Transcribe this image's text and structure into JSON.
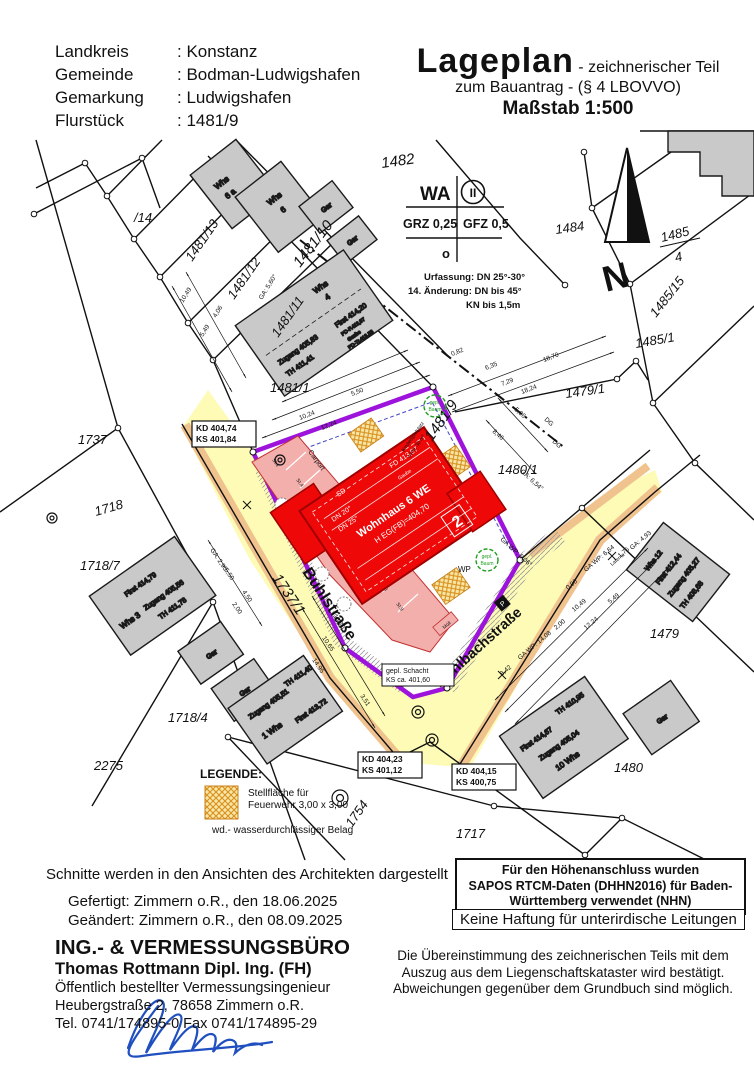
{
  "header": {
    "rows": [
      {
        "label": "Landkreis",
        "value": ": Konstanz"
      },
      {
        "label": "Gemeinde",
        "value": ": Bodman-Ludwigshafen"
      },
      {
        "label": "Gemarkung",
        "value": ": Ludwigshafen"
      },
      {
        "label": "Flurstück",
        "value": ": 1481/9"
      }
    ]
  },
  "title": {
    "main": "Lageplan",
    "sub": "- zeichnerischer Teil",
    "line2": "zum Bauantrag - (§ 4 LBOVVO)",
    "scale": "Maßstab 1:500"
  },
  "zone": {
    "wa": "WA",
    "storeys": "II",
    "grz": "GRZ 0,25",
    "gfz": "GFZ 0,5",
    "open": "o",
    "note1": "Urfassung: DN 25°-30°",
    "note2": "14. Änderung: DN bis 45°",
    "note3": "KN bis 1,5m"
  },
  "north": {
    "n": "N"
  },
  "parcels": {
    "p14": "/14",
    "p1481_13": "1481/13",
    "p1481_12": "1481/12",
    "p1481_11": "1481/11",
    "p1481_10": "1481/10",
    "p1482": "1482",
    "p1484": "1484",
    "p1485_4a": "1485",
    "p1485_4b": "4",
    "p1485_15": "1485/15",
    "p1485_1": "1485/1",
    "p1479_1": "1479/1",
    "p1481_1": "1481/1",
    "p1481_9": "1481/9",
    "p1480_1": "1480/1",
    "p1737": "1737",
    "p1718": "1718",
    "p1718_7": "1718/7",
    "p1737_1": "1737/1",
    "p1718_4": "1718/4",
    "p2275": "2275",
    "p1479": "1479",
    "p1480": "1480",
    "p1754": "1754",
    "p1717": "1717"
  },
  "streets": {
    "buhl": "Buhlstraße",
    "muehl": "Mühlbachstraße"
  },
  "mainBuilding": {
    "name": "Wohnhaus 6 WE",
    "heg": "H EG(FB)=404,70",
    "gaube": "Gaube",
    "fd": "FD 413,57",
    "dn1": "DN 20°",
    "dn2": "DN 25°",
    "sd": "SD",
    "num": "2",
    "kind1": "Kinderspielplatz",
    "kind2": "mind. 30 m²"
  },
  "stalls": {
    "carport": "Carport",
    "s1": "St.1",
    "s4": "St.4",
    "s5": "St.5",
    "s6": "St.6",
    "s7": "St.7",
    "s8": "St.8",
    "s9": "St.9",
    "zugwd": "Zugang wd",
    "egterr": "EG Terr / OG Balk"
  },
  "buildings": {
    "whs6a_1": "Whs",
    "whs6a_2": "6 a",
    "whs6_1": "Whs",
    "whs6_2": "6",
    "gar": "Gar",
    "whs4": {
      "n1": "Whs",
      "n2": "4",
      "zugang": "Zugang 405,83",
      "th": "TH 411,41",
      "first": "First 414,20",
      "gaube": "Gaube",
      "pdf": "PD-F.413,97",
      "pdtr": "PD-Tr.413,53"
    },
    "whs3": {
      "first": "First 414,79",
      "name": "Whs 3",
      "zugang": "Zugang 405,56",
      "th": "TH 411,78"
    },
    "whs1": {
      "zugang": "Zugang 405,51",
      "th": "TH 411,40",
      "name": "1 Whs",
      "first": "First 413,72"
    },
    "whs10": {
      "first": "First 414,67",
      "zugang": "Zugang 405,04",
      "th": "TH 410,95",
      "name": "10 Whs"
    },
    "whs12": {
      "name": "Whs 12",
      "first": "First 412,44",
      "zugang": "Zugang 405,27",
      "th": "TH 408,68"
    }
  },
  "markers": {
    "wp": "WP",
    "muell": "Müll",
    "p": "P",
    "laterne": "Laterne",
    "baum1": "gepl.",
    "baum2": "Baum",
    "schacht1": "gepl. Schacht",
    "schacht2": "KS ca. 401,60"
  },
  "kd": {
    "b1a": "KD 404,74",
    "b1b": "KS 401,84",
    "b2a": "KD 404,23",
    "b2b": "KS 401,12",
    "b3a": "KD 404,15",
    "b3b": "KS 400,75"
  },
  "dims": {
    "d1": "10,49",
    "d2": "5,49",
    "d3": "4,06",
    "d4": "GA: 5,60°",
    "d5": "10,24",
    "d6": "12,24",
    "d7": "5,50",
    "d8": "6,35",
    "d9": "7,29",
    "d10": "18,70",
    "d11": "18,24",
    "d12": "5,06",
    "d13": "8,46",
    "d14": "GA: 6,54°",
    "d15": "GA WP: 6,06°",
    "d16": "GA WP: 14,08",
    "d17": "8,42",
    "d18": "2,00",
    "d19": "10,49",
    "d20": "12,24",
    "d21": "5,49",
    "d22": "GA WP: 6,64",
    "d23": "1,75",
    "d24": "GA: 4,93",
    "d25": "14,95",
    "d26": "10,65",
    "d27": "18,70",
    "d28": "3,51",
    "d29": "GA: 2,90",
    "d30": "5,50",
    "d31": "4,50",
    "d32": "2,00",
    "d33": "0,82",
    "d34": "0,90",
    "d35": "DG",
    "d36": "DG"
  },
  "legend": {
    "title": "LEGENDE:",
    "i1a": "Stellfläche für",
    "i1b": "Feuerwehr 3,00 x 3,00",
    "i2": "wd.- wasserdurchlässiger Belag"
  },
  "notes": {
    "h1": "Für den Höhenanschluss wurden",
    "h2": "SAPOS RTCM-Daten (DHHN2016) für Baden-",
    "h3": "Württemberg verwendet (NHN)",
    "haftung": "Keine Haftung für unterirdische Leitungen",
    "b1": "Die Übereinstimmung des zeichnerischen Teils mit dem",
    "b2": "Auszug aus dem Liegenschaftskataster wird bestätigt.",
    "b3": "Abweichungen gegenüber dem Grundbuch sind möglich."
  },
  "footer": {
    "schnitte": "Schnitte werden in den Ansichten des Architekten dargestellt",
    "gefertigt": "Gefertigt: Zimmern o.R., den 18.06.2025",
    "geaendert": "Geändert: Zimmern o.R., den 08.09.2025",
    "buero": "ING.- & VERMESSUNGSBÜRO",
    "name": "Thomas Rottmann Dipl. Ing. (FH)",
    "beruf": "Öffentlich bestellter Vermessungsingenieur",
    "adresse": "Heubergstraße 2, 78658 Zimmern o.R.",
    "tel": "Tel. 0741/174895-0 Fax 0741/174895-29"
  },
  "colors": {
    "purple": "#9d13db",
    "red": "#ee0808",
    "pink": "#f3afac",
    "streetYellow": "#fdfbb6",
    "streetEdge": "#f0c38e",
    "grey": "#c9c9c9",
    "green": "#1f9e1f",
    "signature": "#2050c0"
  }
}
